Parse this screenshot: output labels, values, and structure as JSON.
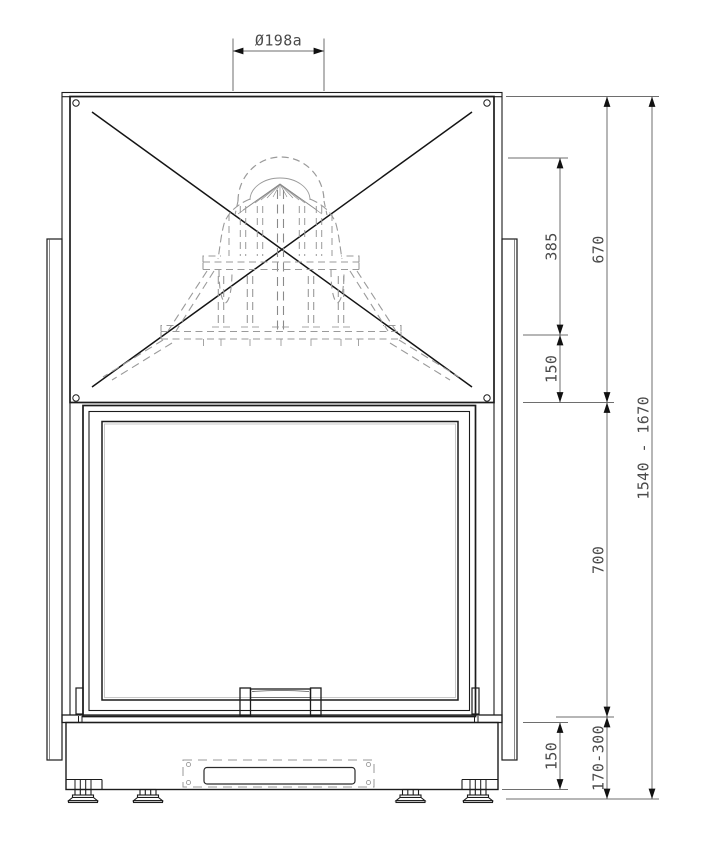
{
  "drawing": {
    "type": "fireplace-insert-front-elevation",
    "line_color": "#1c1c1c",
    "hidden_line_color": "#9a9a9a",
    "dimension_line_color": "#6e6e6e",
    "dimension_text_color": "#4a4a4a",
    "background_color": "#ffffff"
  },
  "dimensions": {
    "flue_diameter": "Ø198a",
    "dome_height": "385",
    "collar_to_hood_bottom": "150",
    "hood_height": "670",
    "door_section_height": "700",
    "plinth_height": "150",
    "base_clearance_range": "170-300",
    "overall_height_range": "1540 - 1670"
  }
}
